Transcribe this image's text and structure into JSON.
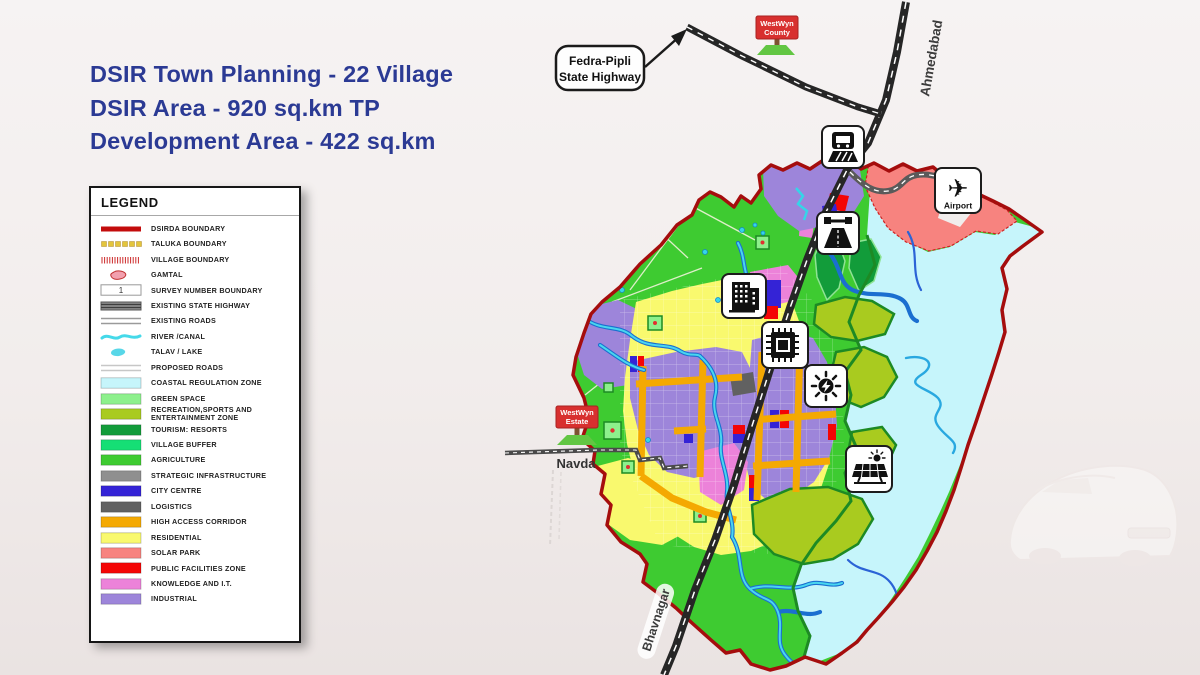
{
  "title": {
    "lines": [
      "DSIR Town Planning - 22 Village",
      "DSIR Area - 920 sq.km TP",
      "Development Area - 422 sq.km"
    ],
    "color": "#2b3a94"
  },
  "legend": {
    "title": "LEGEND",
    "items": [
      {
        "label": "DSIRDA BOUNDARY",
        "swatch": "line-thick",
        "color": "#c30c0c"
      },
      {
        "label": "TALUKA BOUNDARY",
        "swatch": "dashes",
        "color": "#e3c53c"
      },
      {
        "label": "VILLAGE BOUNDARY",
        "swatch": "hatch",
        "color": "#cc2a2a"
      },
      {
        "label": "GAMTAL",
        "swatch": "blob",
        "color": "#f2a0ae",
        "stroke": "#c03030"
      },
      {
        "label": "SURVEY NUMBER BOUNDARY",
        "swatch": "survey",
        "color": "#ffffff",
        "text": "1"
      },
      {
        "label": "EXISTING STATE HIGHWAY",
        "swatch": "highway",
        "color": "#8d8d8d"
      },
      {
        "label": "EXISTING ROADS",
        "swatch": "roads",
        "color": "#9a9a9a"
      },
      {
        "label": "RIVER /CANAL",
        "swatch": "wave",
        "color": "#45d9e9"
      },
      {
        "label": "TALAV / LAKE",
        "swatch": "lake",
        "color": "#58d7e8"
      },
      {
        "label": "PROPOSED ROADS",
        "swatch": "roads-light",
        "color": "#c7c7c7"
      },
      {
        "label": "COASTAL REGULATION ZONE",
        "swatch": "box",
        "color": "#c6f5fb"
      },
      {
        "label": "GREEN SPACE",
        "swatch": "box",
        "color": "#8df08c"
      },
      {
        "label": "RECREATION,SPORTS AND ENTERTAINMENT ZONE",
        "swatch": "box",
        "color": "#a9cb1f"
      },
      {
        "label": "TOURISM: RESORTS",
        "swatch": "box",
        "color": "#129c3a"
      },
      {
        "label": "VILLAGE BUFFER",
        "swatch": "box",
        "color": "#15df75"
      },
      {
        "label": "AGRICULTURE",
        "swatch": "box",
        "color": "#3ecb31"
      },
      {
        "label": "STRATEGIC INFRASTRUCTURE",
        "swatch": "box",
        "color": "#8f8f8f"
      },
      {
        "label": "CITY CENTRE",
        "swatch": "box",
        "color": "#3423d6"
      },
      {
        "label": "LOGISTICS",
        "swatch": "box",
        "color": "#616161"
      },
      {
        "label": "HIGH ACCESS CORRIDOR",
        "swatch": "box",
        "color": "#f4a902"
      },
      {
        "label": "RESIDENTIAL",
        "swatch": "box",
        "color": "#f9f96e"
      },
      {
        "label": "SOLAR PARK",
        "swatch": "box",
        "color": "#f7837f"
      },
      {
        "label": "PUBLIC FACILITIES ZONE",
        "swatch": "box",
        "color": "#f40505"
      },
      {
        "label": "KNOWLEDGE AND I.T.",
        "swatch": "box",
        "color": "#ec82d9"
      },
      {
        "label": "INDUSTRIAL",
        "swatch": "box",
        "color": "#9d85da"
      }
    ]
  },
  "map": {
    "highway_labels": {
      "ahmedabad": "Ahmedabad",
      "bhavnagar": "Bhavnagar"
    },
    "place_labels": {
      "navda": "Navda"
    },
    "airport_label": "Airport",
    "callout": {
      "line1": "Fedra-Pipli",
      "line2": "State Highway"
    },
    "signs": {
      "county": {
        "line1": "WestWyn",
        "line2": "County"
      },
      "estate": {
        "line1": "WestWyn",
        "line2": "Estate"
      }
    },
    "icons": [
      "train-station-icon",
      "toll-road-icon",
      "city-buildings-icon",
      "it-chip-icon",
      "power-energy-icon",
      "solar-park-icon",
      "airport-icon"
    ]
  },
  "colors": {
    "dsirda_boundary": "#a50d0d",
    "highway_black": "#262626",
    "state_highway_gray": "#5a5a5a",
    "river_blue": "#1b6fd0",
    "river_cyan": "#49d6ef",
    "background": "#f1edec",
    "sign_red": "#d8302f",
    "sign_green_base": "#62c643"
  }
}
